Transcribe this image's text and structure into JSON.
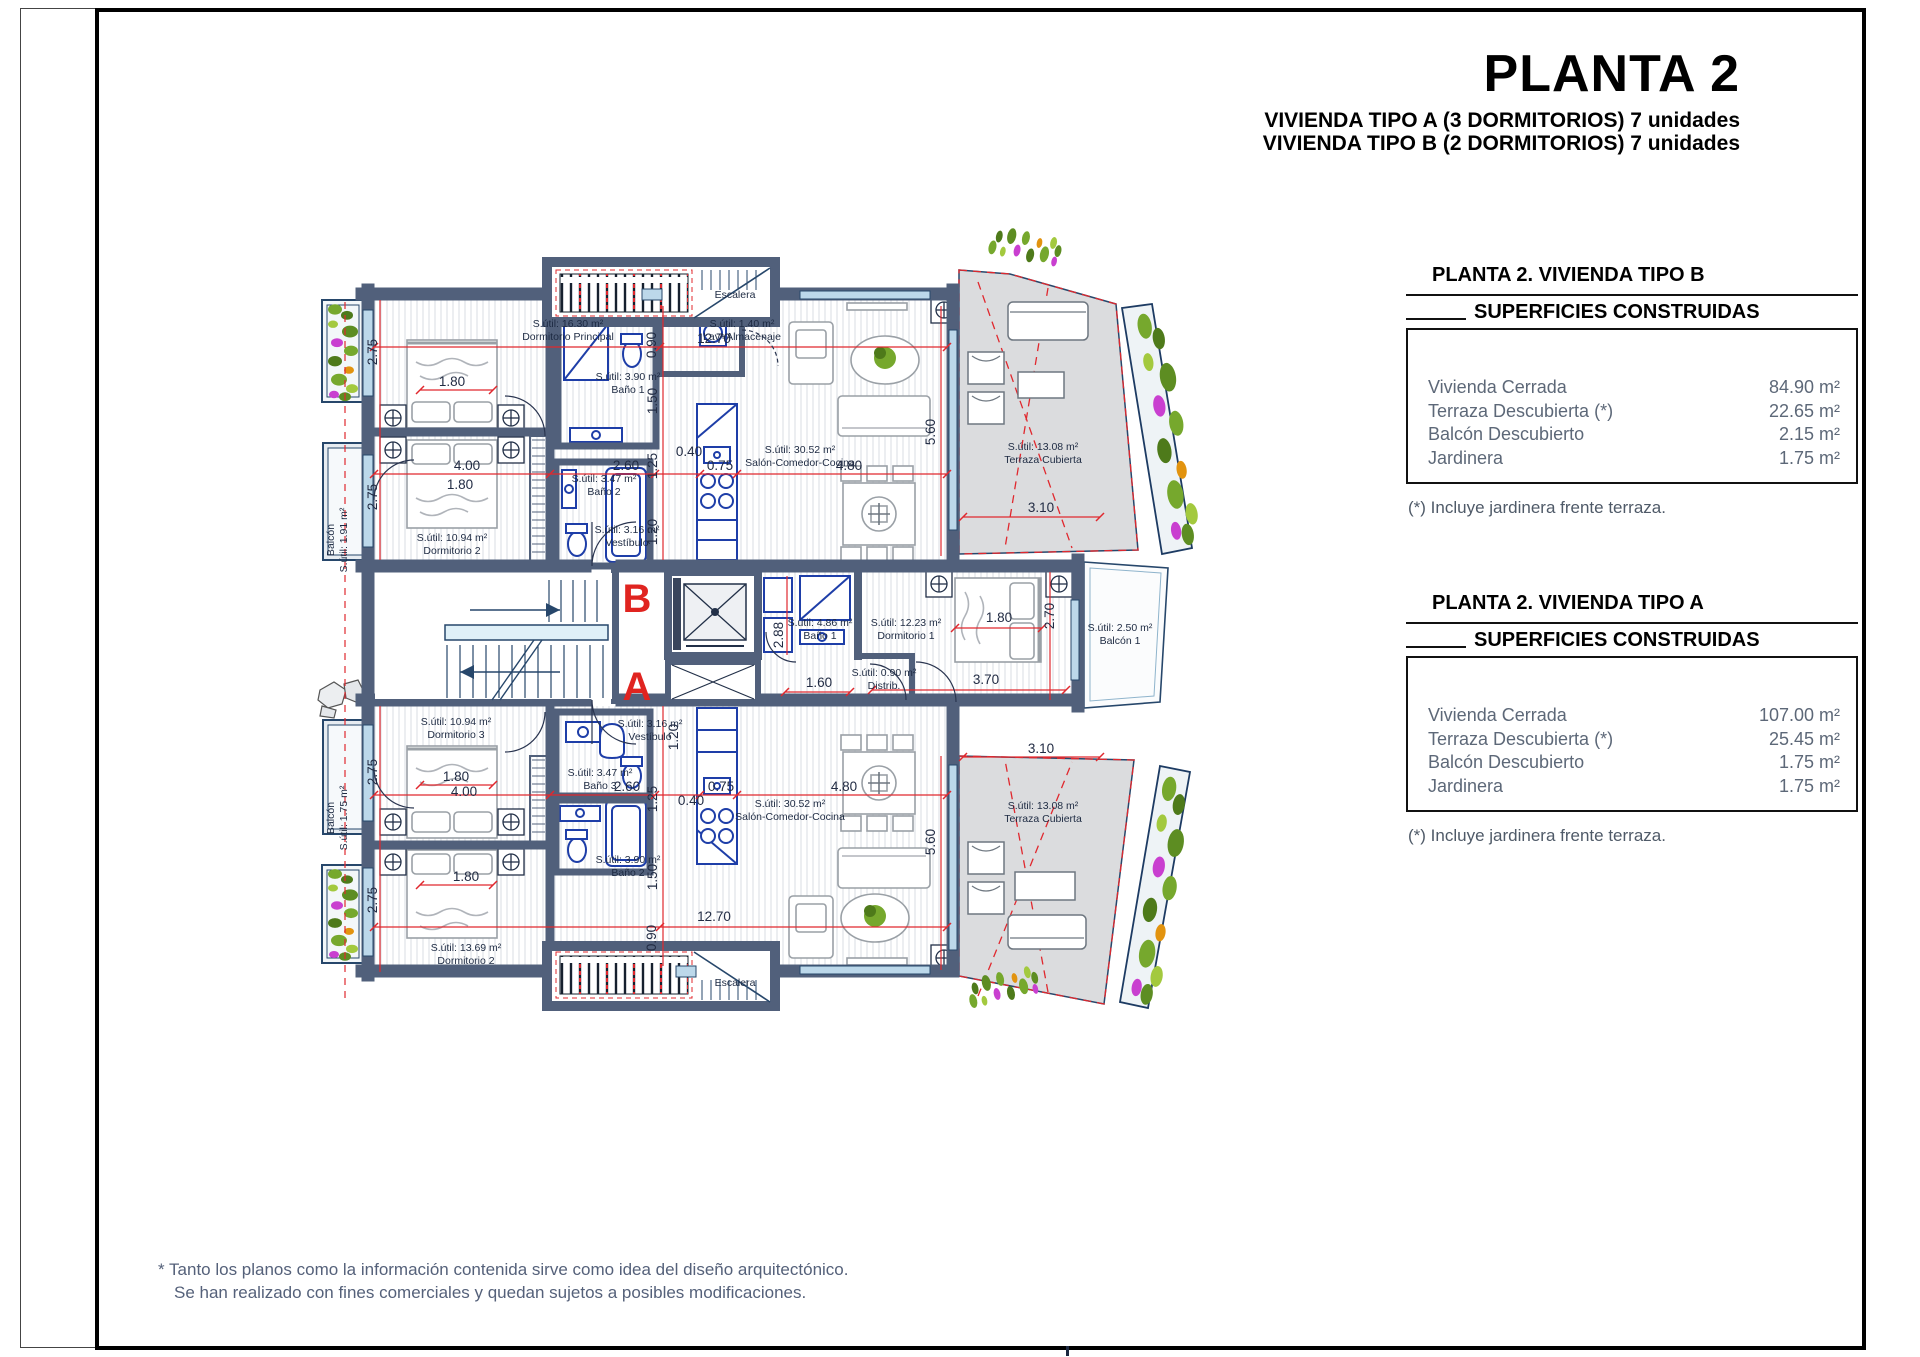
{
  "page": {
    "title": "PLANTA 2",
    "subtitle1": "VIVIENDA TIPO A (3 DORMITORIOS) 7 unidades",
    "subtitle2": "VIVIENDA TIPO B (2 DORMITORIOS) 7 unidades",
    "footnote_line1": "* Tanto los planos como la información contenida sirve como idea del diseño arquitectónico.",
    "footnote_line2": "Se han realizado con fines comerciales y quedan sujetos a posibles modificaciones."
  },
  "summary_boxes": [
    {
      "heading": "PLANTA 2. VIVIENDA TIPO B",
      "subheading": "SUPERFICIES CONSTRUIDAS",
      "rows": [
        {
          "label": "Vivienda Cerrada",
          "value": "84.90 m²"
        },
        {
          "label": "Terraza Descubierta (*)",
          "value": "22.65 m²"
        },
        {
          "label": "Balcón Descubierto",
          "value": "2.15 m²"
        },
        {
          "label": "Jardinera",
          "value": "1.75 m²"
        }
      ],
      "footnote": "(*) Incluye jardinera frente terraza."
    },
    {
      "heading": "PLANTA 2. VIVIENDA TIPO A",
      "subheading": "SUPERFICIES CONSTRUIDAS",
      "rows": [
        {
          "label": "Vivienda Cerrada",
          "value": "107.00 m²"
        },
        {
          "label": "Terraza Descubierta (*)",
          "value": "25.45 m²"
        },
        {
          "label": "Balcón Descubierto",
          "value": "1.75 m²"
        },
        {
          "label": "Jardinera",
          "value": "1.75 m²"
        }
      ],
      "footnote": "(*) Incluye jardinera frente terraza."
    }
  ],
  "plan": {
    "unit_b_letter": "B",
    "unit_a_letter": "A",
    "colors": {
      "wall": "#51607b",
      "fixture_blue": "#1e3ea8",
      "dimension_red": "#e0282e",
      "unit_letter_red": "#e02420",
      "terrace_gray": "#dbdcde"
    },
    "room_labels": [
      {
        "lines": [
          "S.útil: 16.30 m²",
          "Dormitorio Principal"
        ],
        "x": 568,
        "y": 327
      },
      {
        "lines": [
          "S.útil: 3.90 m²",
          "Baño 1"
        ],
        "x": 628,
        "y": 380
      },
      {
        "lines": [
          "S.útil: 1.40 m²",
          "Lav+Almacenaje"
        ],
        "x": 742,
        "y": 327
      },
      {
        "lines": [
          "S.útil: 30.52 m²",
          "Salón-Comedor-Cocina"
        ],
        "x": 800,
        "y": 453
      },
      {
        "lines": [
          "S.útil: 10.94 m²",
          "Dormitorio 2"
        ],
        "x": 452,
        "y": 541
      },
      {
        "lines": [
          "S.útil: 3.47 m²",
          "Baño 2"
        ],
        "x": 604,
        "y": 482
      },
      {
        "lines": [
          "S.útil: 3.16 m²",
          "Vestíbulo"
        ],
        "x": 627,
        "y": 533
      },
      {
        "lines": [
          "S.útil: 13.08 m²",
          "Terraza Cubierta"
        ],
        "x": 1043,
        "y": 450
      },
      {
        "lines": [
          "Balcón",
          "S.útil: 1.91 m²"
        ],
        "x": 334,
        "y": 540,
        "rot": 1
      },
      {
        "lines": [
          "Escalera"
        ],
        "x": 735,
        "y": 298
      },
      {
        "lines": [
          "S.útil: 4.86 m²",
          "Baño 1"
        ],
        "x": 820,
        "y": 626
      },
      {
        "lines": [
          "S.útil: 12.23 m²",
          "Dormitorio 1"
        ],
        "x": 906,
        "y": 626
      },
      {
        "lines": [
          "S.útil: 0.90 m²",
          "Distrib."
        ],
        "x": 884,
        "y": 676
      },
      {
        "lines": [
          "S.útil: 2.50 m²",
          "Balcón 1"
        ],
        "x": 1120,
        "y": 631
      },
      {
        "lines": [
          "S.útil: 10.94 m²",
          "Dormitorio 3"
        ],
        "x": 456,
        "y": 725
      },
      {
        "lines": [
          "S.útil: 3.47 m²",
          "Baño 3"
        ],
        "x": 600,
        "y": 776
      },
      {
        "lines": [
          "S.útil: 3.90 m²",
          "Baño 2"
        ],
        "x": 628,
        "y": 863
      },
      {
        "lines": [
          "S.útil: 3.16 m²",
          "Vestíbulo"
        ],
        "x": 650,
        "y": 727
      },
      {
        "lines": [
          "S.útil: 30.52 m²",
          "Salón-Comedor-Cocina"
        ],
        "x": 790,
        "y": 807
      },
      {
        "lines": [
          "S.útil: 13.69 m²",
          "Dormitorio 2"
        ],
        "x": 466,
        "y": 951
      },
      {
        "lines": [
          "S.útil: 13.08 m²",
          "Terraza Cubierta"
        ],
        "x": 1043,
        "y": 809
      },
      {
        "lines": [
          "Balcón",
          "S.útil: 1.75 m²"
        ],
        "x": 334,
        "y": 818,
        "rot": 1
      },
      {
        "lines": [
          "Escalera"
        ],
        "x": 735,
        "y": 986
      }
    ],
    "dim_labels": [
      {
        "t": "2.75",
        "x": 377,
        "y": 352,
        "rot": 1
      },
      {
        "t": "2.75",
        "x": 377,
        "y": 497,
        "rot": 1
      },
      {
        "t": "1.80",
        "x": 452,
        "y": 386
      },
      {
        "t": "4.00",
        "x": 467,
        "y": 470
      },
      {
        "t": "1.80",
        "x": 460,
        "y": 489
      },
      {
        "t": "12.70",
        "x": 714,
        "y": 343
      },
      {
        "t": "0.90",
        "x": 656,
        "y": 345,
        "rot": 1
      },
      {
        "t": "2.60",
        "x": 626,
        "y": 470
      },
      {
        "t": "1.25",
        "x": 657,
        "y": 466,
        "rot": 1
      },
      {
        "t": "0.40",
        "x": 689,
        "y": 456
      },
      {
        "t": "0.75",
        "x": 720,
        "y": 470
      },
      {
        "t": "4.80",
        "x": 849,
        "y": 470
      },
      {
        "t": "5.60",
        "x": 935,
        "y": 432,
        "rot": 1
      },
      {
        "t": "1.50",
        "x": 657,
        "y": 401,
        "rot": 1
      },
      {
        "t": "1.20",
        "x": 657,
        "y": 532,
        "rot": 1
      },
      {
        "t": "3.10",
        "x": 1041,
        "y": 512
      },
      {
        "t": "2.88",
        "x": 783,
        "y": 635,
        "rot": 1
      },
      {
        "t": "1.60",
        "x": 819,
        "y": 687
      },
      {
        "t": "1.80",
        "x": 999,
        "y": 622
      },
      {
        "t": "2.70",
        "x": 1054,
        "y": 616,
        "rot": 1
      },
      {
        "t": "3.70",
        "x": 986,
        "y": 684
      },
      {
        "t": "2.75",
        "x": 377,
        "y": 772,
        "rot": 1
      },
      {
        "t": "2.75",
        "x": 377,
        "y": 900,
        "rot": 1
      },
      {
        "t": "1.80",
        "x": 456,
        "y": 781
      },
      {
        "t": "4.00",
        "x": 464,
        "y": 796
      },
      {
        "t": "1.80",
        "x": 466,
        "y": 881
      },
      {
        "t": "2.60",
        "x": 627,
        "y": 791
      },
      {
        "t": "1.25",
        "x": 657,
        "y": 799,
        "rot": 1
      },
      {
        "t": "0.40",
        "x": 691,
        "y": 805
      },
      {
        "t": "0.75",
        "x": 721,
        "y": 791
      },
      {
        "t": "4.80",
        "x": 844,
        "y": 791
      },
      {
        "t": "5.60",
        "x": 935,
        "y": 842,
        "rot": 1
      },
      {
        "t": "1.50",
        "x": 657,
        "y": 877,
        "rot": 1
      },
      {
        "t": "1.20",
        "x": 678,
        "y": 737,
        "rot": 1
      },
      {
        "t": "12.70",
        "x": 714,
        "y": 921
      },
      {
        "t": "0.90",
        "x": 656,
        "y": 938,
        "rot": 1
      },
      {
        "t": "3.10",
        "x": 1041,
        "y": 753
      }
    ]
  }
}
